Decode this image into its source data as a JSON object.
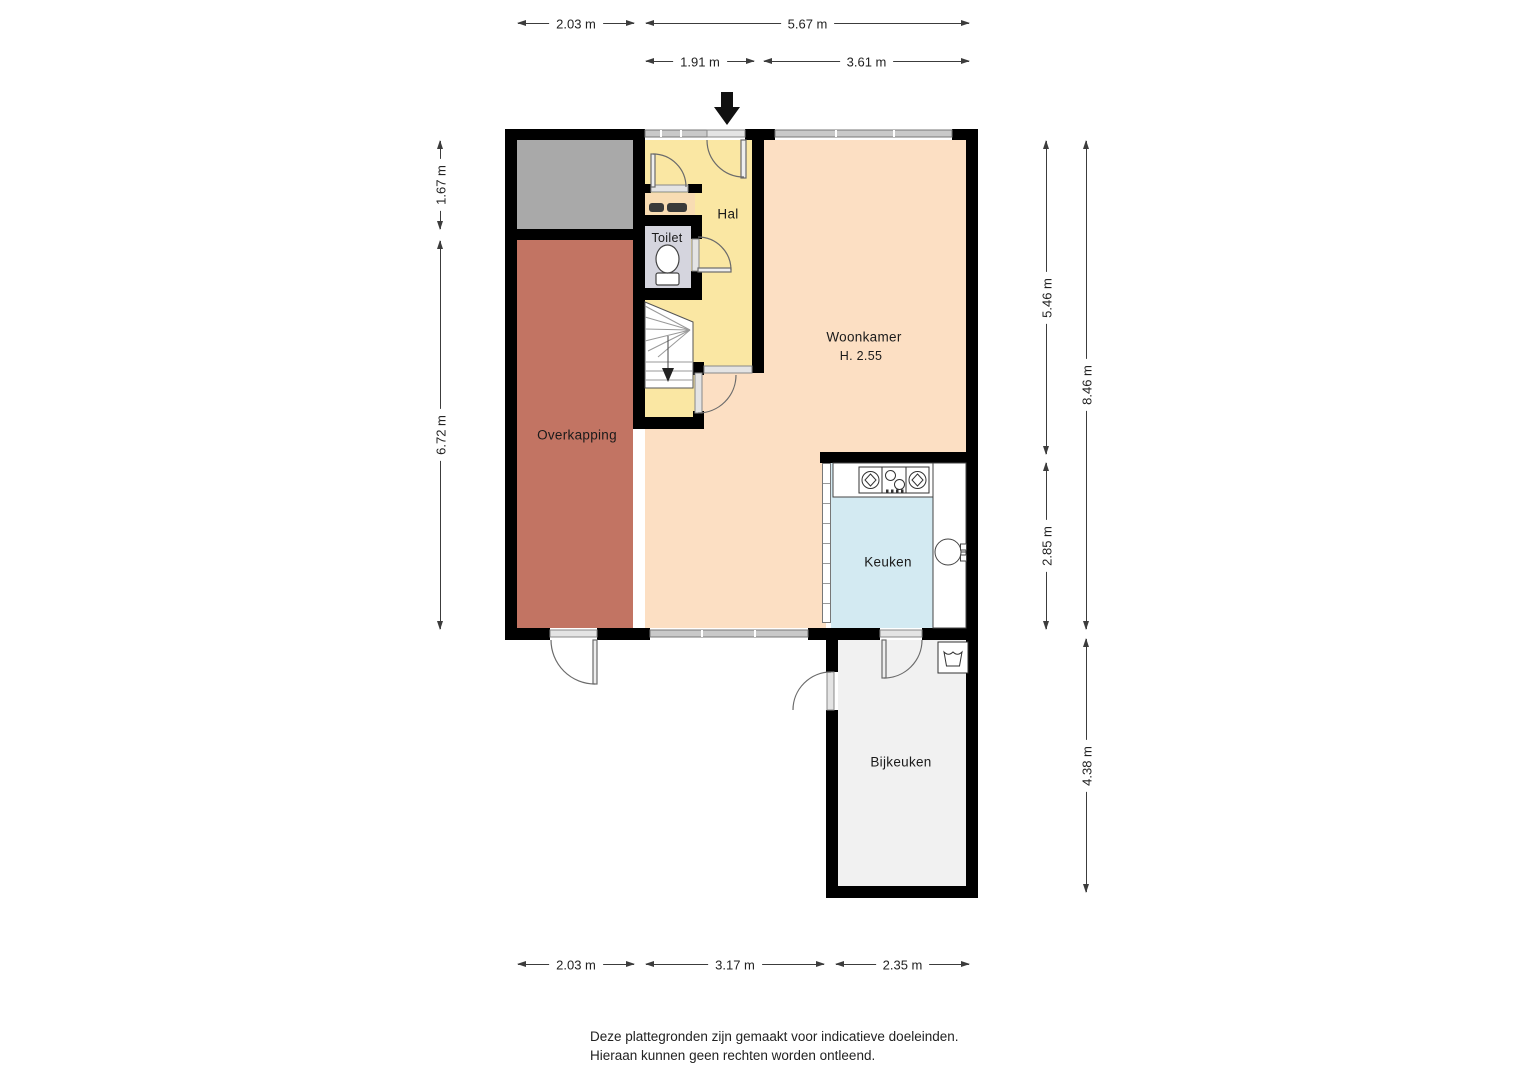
{
  "rooms": {
    "hal": {
      "label": "Hal"
    },
    "toilet": {
      "label": "Toilet"
    },
    "woonkamer": {
      "label": "Woonkamer",
      "height_note": "H. 2.55"
    },
    "overkapping": {
      "label": "Overkapping"
    },
    "keuken": {
      "label": "Keuken"
    },
    "bijkeuken": {
      "label": "Bijkeuken"
    }
  },
  "colors": {
    "wall": "#000000",
    "storage": "#a9a9a9",
    "overkapping": "#c27463",
    "hal": "#fae7a3",
    "meterkast": "#f8dcb3",
    "toilet": "#d5d5de",
    "woonkamer": "#fcdfc3",
    "keuken": "#d3eaf2",
    "bijkeuken": "#f1f1f1"
  },
  "dimensions": {
    "top_outer": [
      {
        "label": "2.03 m"
      },
      {
        "label": "5.67 m"
      }
    ],
    "top_inner": [
      {
        "label": "1.91 m"
      },
      {
        "label": "3.61 m"
      }
    ],
    "left": [
      {
        "label": "1.67 m"
      },
      {
        "label": "6.72 m"
      }
    ],
    "right_inner": [
      {
        "label": "5.46 m"
      },
      {
        "label": "2.85 m"
      }
    ],
    "right_outer": [
      {
        "label": "8.46 m"
      },
      {
        "label": "4.38 m"
      }
    ],
    "bottom": [
      {
        "label": "2.03 m"
      },
      {
        "label": "3.17 m"
      },
      {
        "label": "2.35 m"
      }
    ]
  },
  "footer": {
    "line1": "Deze plattegronden zijn gemaakt voor indicatieve doeleinden.",
    "line2": "Hieraan kunnen geen rechten worden ontleend."
  }
}
